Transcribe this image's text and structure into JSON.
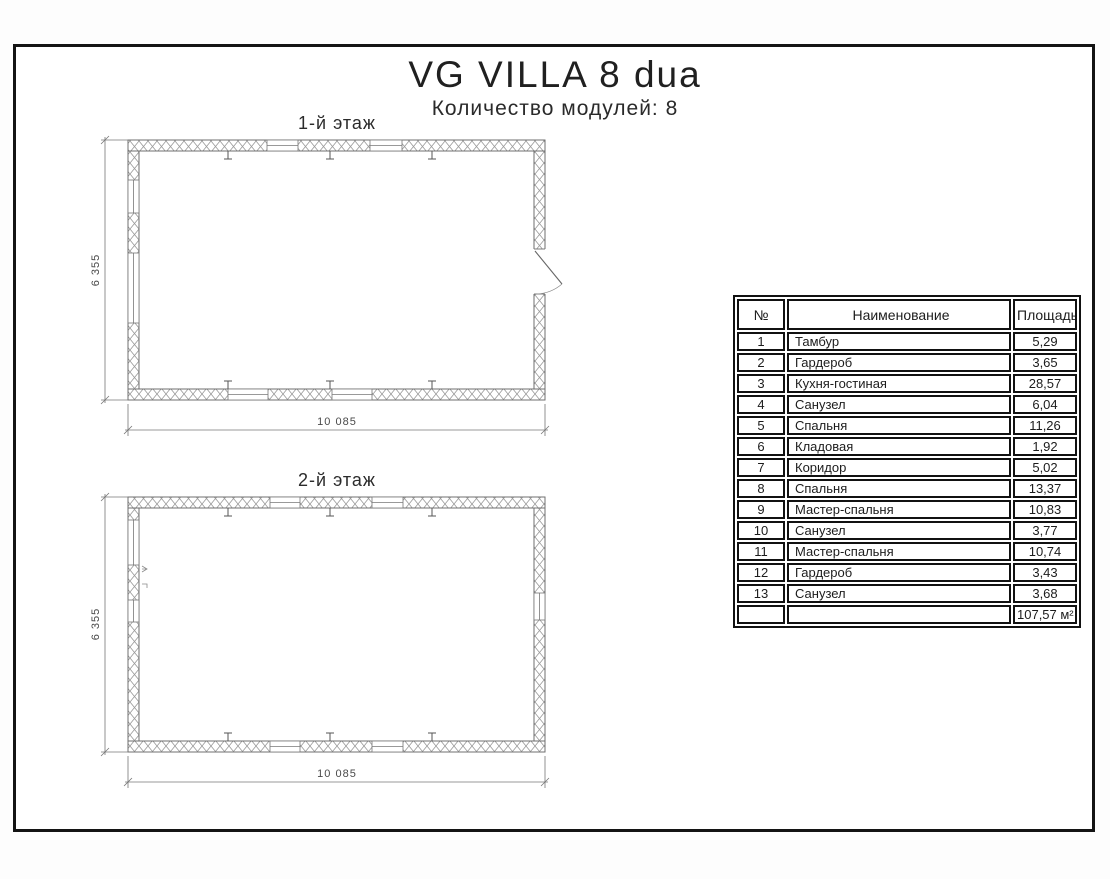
{
  "page": {
    "title": "VG VILLA 8 dua",
    "subtitle": "Количество модулей: 8"
  },
  "drawing": {
    "floor1": {
      "label": "1-й этаж",
      "height_dim": "6 355",
      "width_dim": "10 085"
    },
    "floor2": {
      "label": "2-й этаж",
      "height_dim": "6 355",
      "width_dim": "10 085"
    }
  },
  "table": {
    "headers": [
      "№",
      "Наименование",
      "Площадь"
    ],
    "rows": [
      [
        "1",
        "Тамбур",
        "5,29"
      ],
      [
        "2",
        "Гардероб",
        "3,65"
      ],
      [
        "3",
        "Кухня-гостиная",
        "28,57"
      ],
      [
        "4",
        "Санузел",
        "6,04"
      ],
      [
        "5",
        "Спальня",
        "11,26"
      ],
      [
        "6",
        "Кладовая",
        "1,92"
      ],
      [
        "7",
        "Коридор",
        "5,02"
      ],
      [
        "8",
        "Спальня",
        "13,37"
      ],
      [
        "9",
        "Мастер-спальня",
        "10,83"
      ],
      [
        "10",
        "Санузел",
        "3,77"
      ],
      [
        "11",
        "Мастер-спальня",
        "10,74"
      ],
      [
        "12",
        "Гардероб",
        "3,43"
      ],
      [
        "13",
        "Санузел",
        "3,68"
      ]
    ],
    "total": "107,57 м²"
  }
}
